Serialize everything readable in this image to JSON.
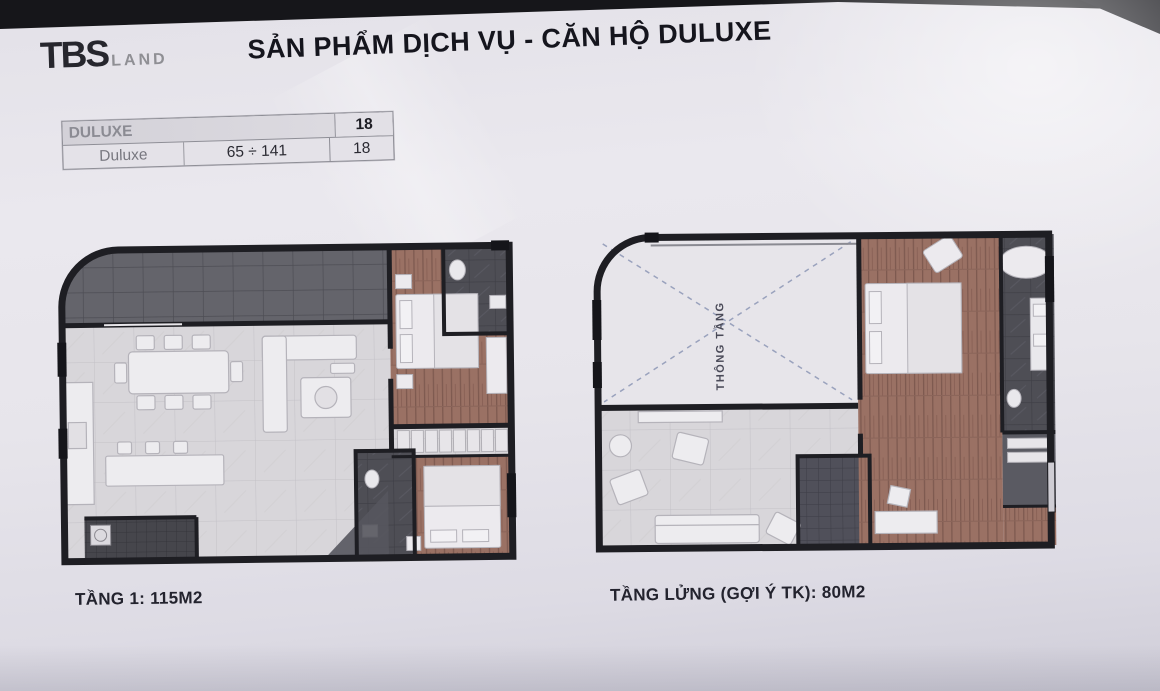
{
  "header": {
    "logo": {
      "primary": "TBS",
      "secondary": "LAND"
    },
    "title": "SẢN PHẨM DỊCH VỤ - CĂN HỘ DULUXE"
  },
  "table": {
    "header_row": {
      "label": "DULUXE",
      "value": "18"
    },
    "data_row": {
      "label": "Duluxe",
      "range": "65 ÷ 141",
      "value": "18"
    }
  },
  "floor_plans": [
    {
      "caption": "TẦNG 1: 115M2"
    },
    {
      "caption": "TẦNG LỬNG (GỢI Ý TK): 80M2",
      "annotation": "THÔNG TẦNG"
    }
  ],
  "colors": {
    "slide_background": "#e7e5eb",
    "top_bar": "#16161a",
    "wall": "#1e1e23",
    "wood_floor": "#9a7164",
    "marble_floor": "#d8d6da",
    "dark_tile": "#63636a",
    "bath_tile": "#4e4e55",
    "title_text": "#15151d",
    "muted_text": "#8b8b93"
  }
}
